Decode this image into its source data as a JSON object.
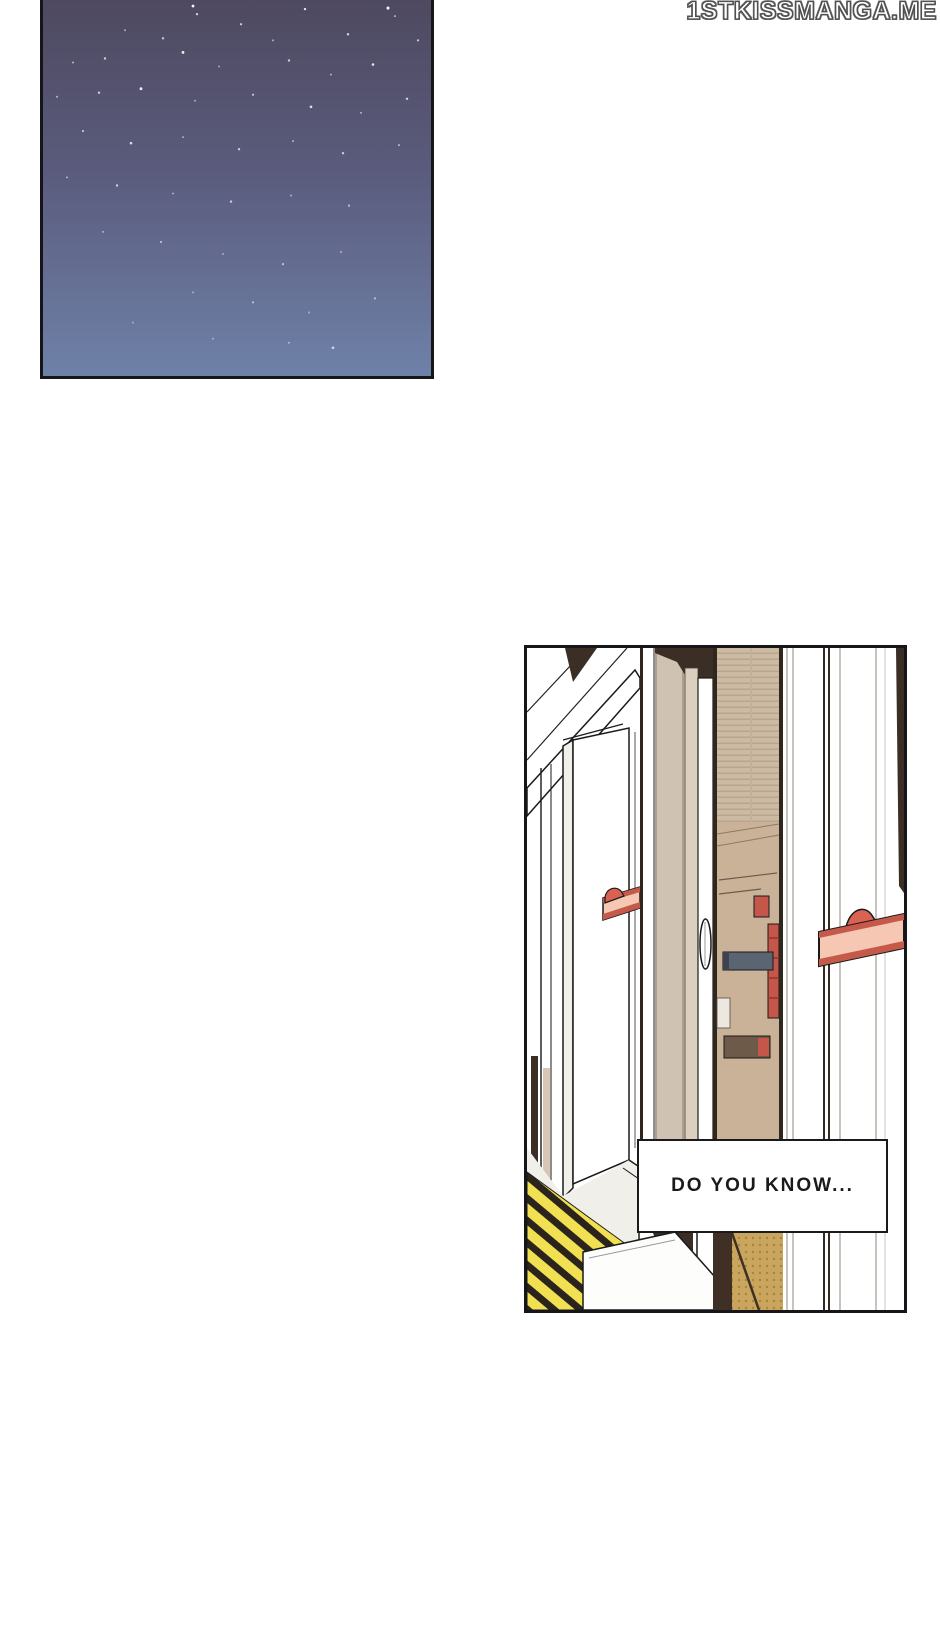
{
  "watermark": {
    "text": "1STKISSMANGA.ME",
    "fill": "#ffffff",
    "outline": "#4f4f4f"
  },
  "panels": {
    "night_sky": {
      "description": "starry night sky",
      "colors": {
        "sky_top": "#4e4960",
        "sky_middle": "#5a5b7c",
        "sky_bottom": "#6f81a8",
        "star": "#ffffff",
        "border": "#15151a"
      }
    },
    "train_door": {
      "description": "open train doorway with platform safety strip",
      "speech_text": "DO YOU KNOW...",
      "colors": {
        "line": "#1a1a1a",
        "beige_frame": "#cfc2b3",
        "tan_interior": "#cdbaa3",
        "tan_wall": "#c9b298",
        "gold_floor": "#c9a55e",
        "handle_fill": "#f6c7b2",
        "handle_edge": "#c65a4a",
        "handle_bump": "#d96252",
        "accent_red": "#c4574a",
        "gray_bar": "#5a6472",
        "dark_wood": "#3b2f25",
        "stripe_yellow": "#f0e052",
        "stripe_black": "#2b241c"
      }
    }
  }
}
